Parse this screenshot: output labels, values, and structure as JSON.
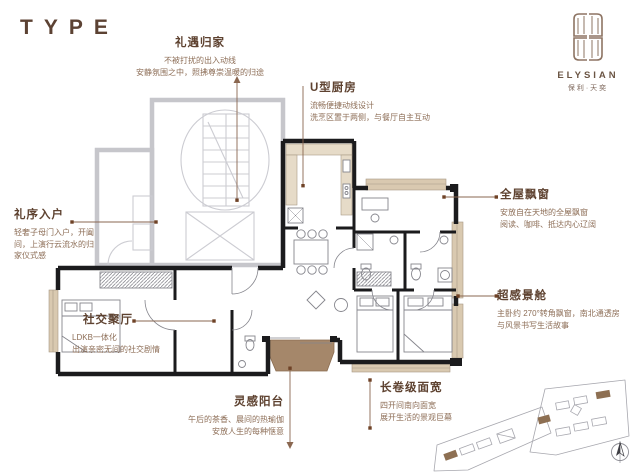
{
  "page": {
    "type_label": "TYPE"
  },
  "brand": {
    "name": "ELYSIAN",
    "cn_name": "保利·天奕",
    "logo_icon": "double-door-monogram"
  },
  "annotations": {
    "homecoming": {
      "title": "礼遇归家",
      "lines": [
        "不被打扰的出入动线",
        "安静氛围之中，照拂尊崇温暖的归途"
      ]
    },
    "kitchen": {
      "title": "U型厨房",
      "lines": [
        "流畅便捷动线设计",
        "洗烹区置于两侧，与餐厅自主互动"
      ]
    },
    "bay_window": {
      "title": "全屋飘窗",
      "lines": [
        "安放自在天地的全屋飘窗",
        "阅读、咖啡、抵达内心辽阔"
      ]
    },
    "view_cabin": {
      "title": "超感景舱",
      "lines": [
        "主卧约 270°转角飘窗，南北通透房",
        "与风景书写生活故事"
      ]
    },
    "entry": {
      "title": "礼序入户",
      "lines": [
        "轻奢子母门入户，开阖",
        "间，上演行云流水的归",
        "家仪式感"
      ]
    },
    "social_hall": {
      "title": "社交聚厅",
      "lines": [
        "LDKB一体化",
        "出演亲密无间的社交剧情"
      ]
    },
    "balcony": {
      "title": "灵感阳台",
      "lines": [
        "午后的茶香、晨间的热瑜伽",
        "安放人生的每种惬意"
      ]
    },
    "frontage": {
      "title": "长卷级面宽",
      "lines": [
        "四开间南向面宽",
        "展开生活的景观巨幕"
      ]
    }
  },
  "colors": {
    "accent_brown": "#7a5740",
    "wall_black": "#1a1a1a",
    "core_gray": "#c6c6cc",
    "bay_tan": "#d9c9b0",
    "balcony_brown": "#a5876a"
  }
}
